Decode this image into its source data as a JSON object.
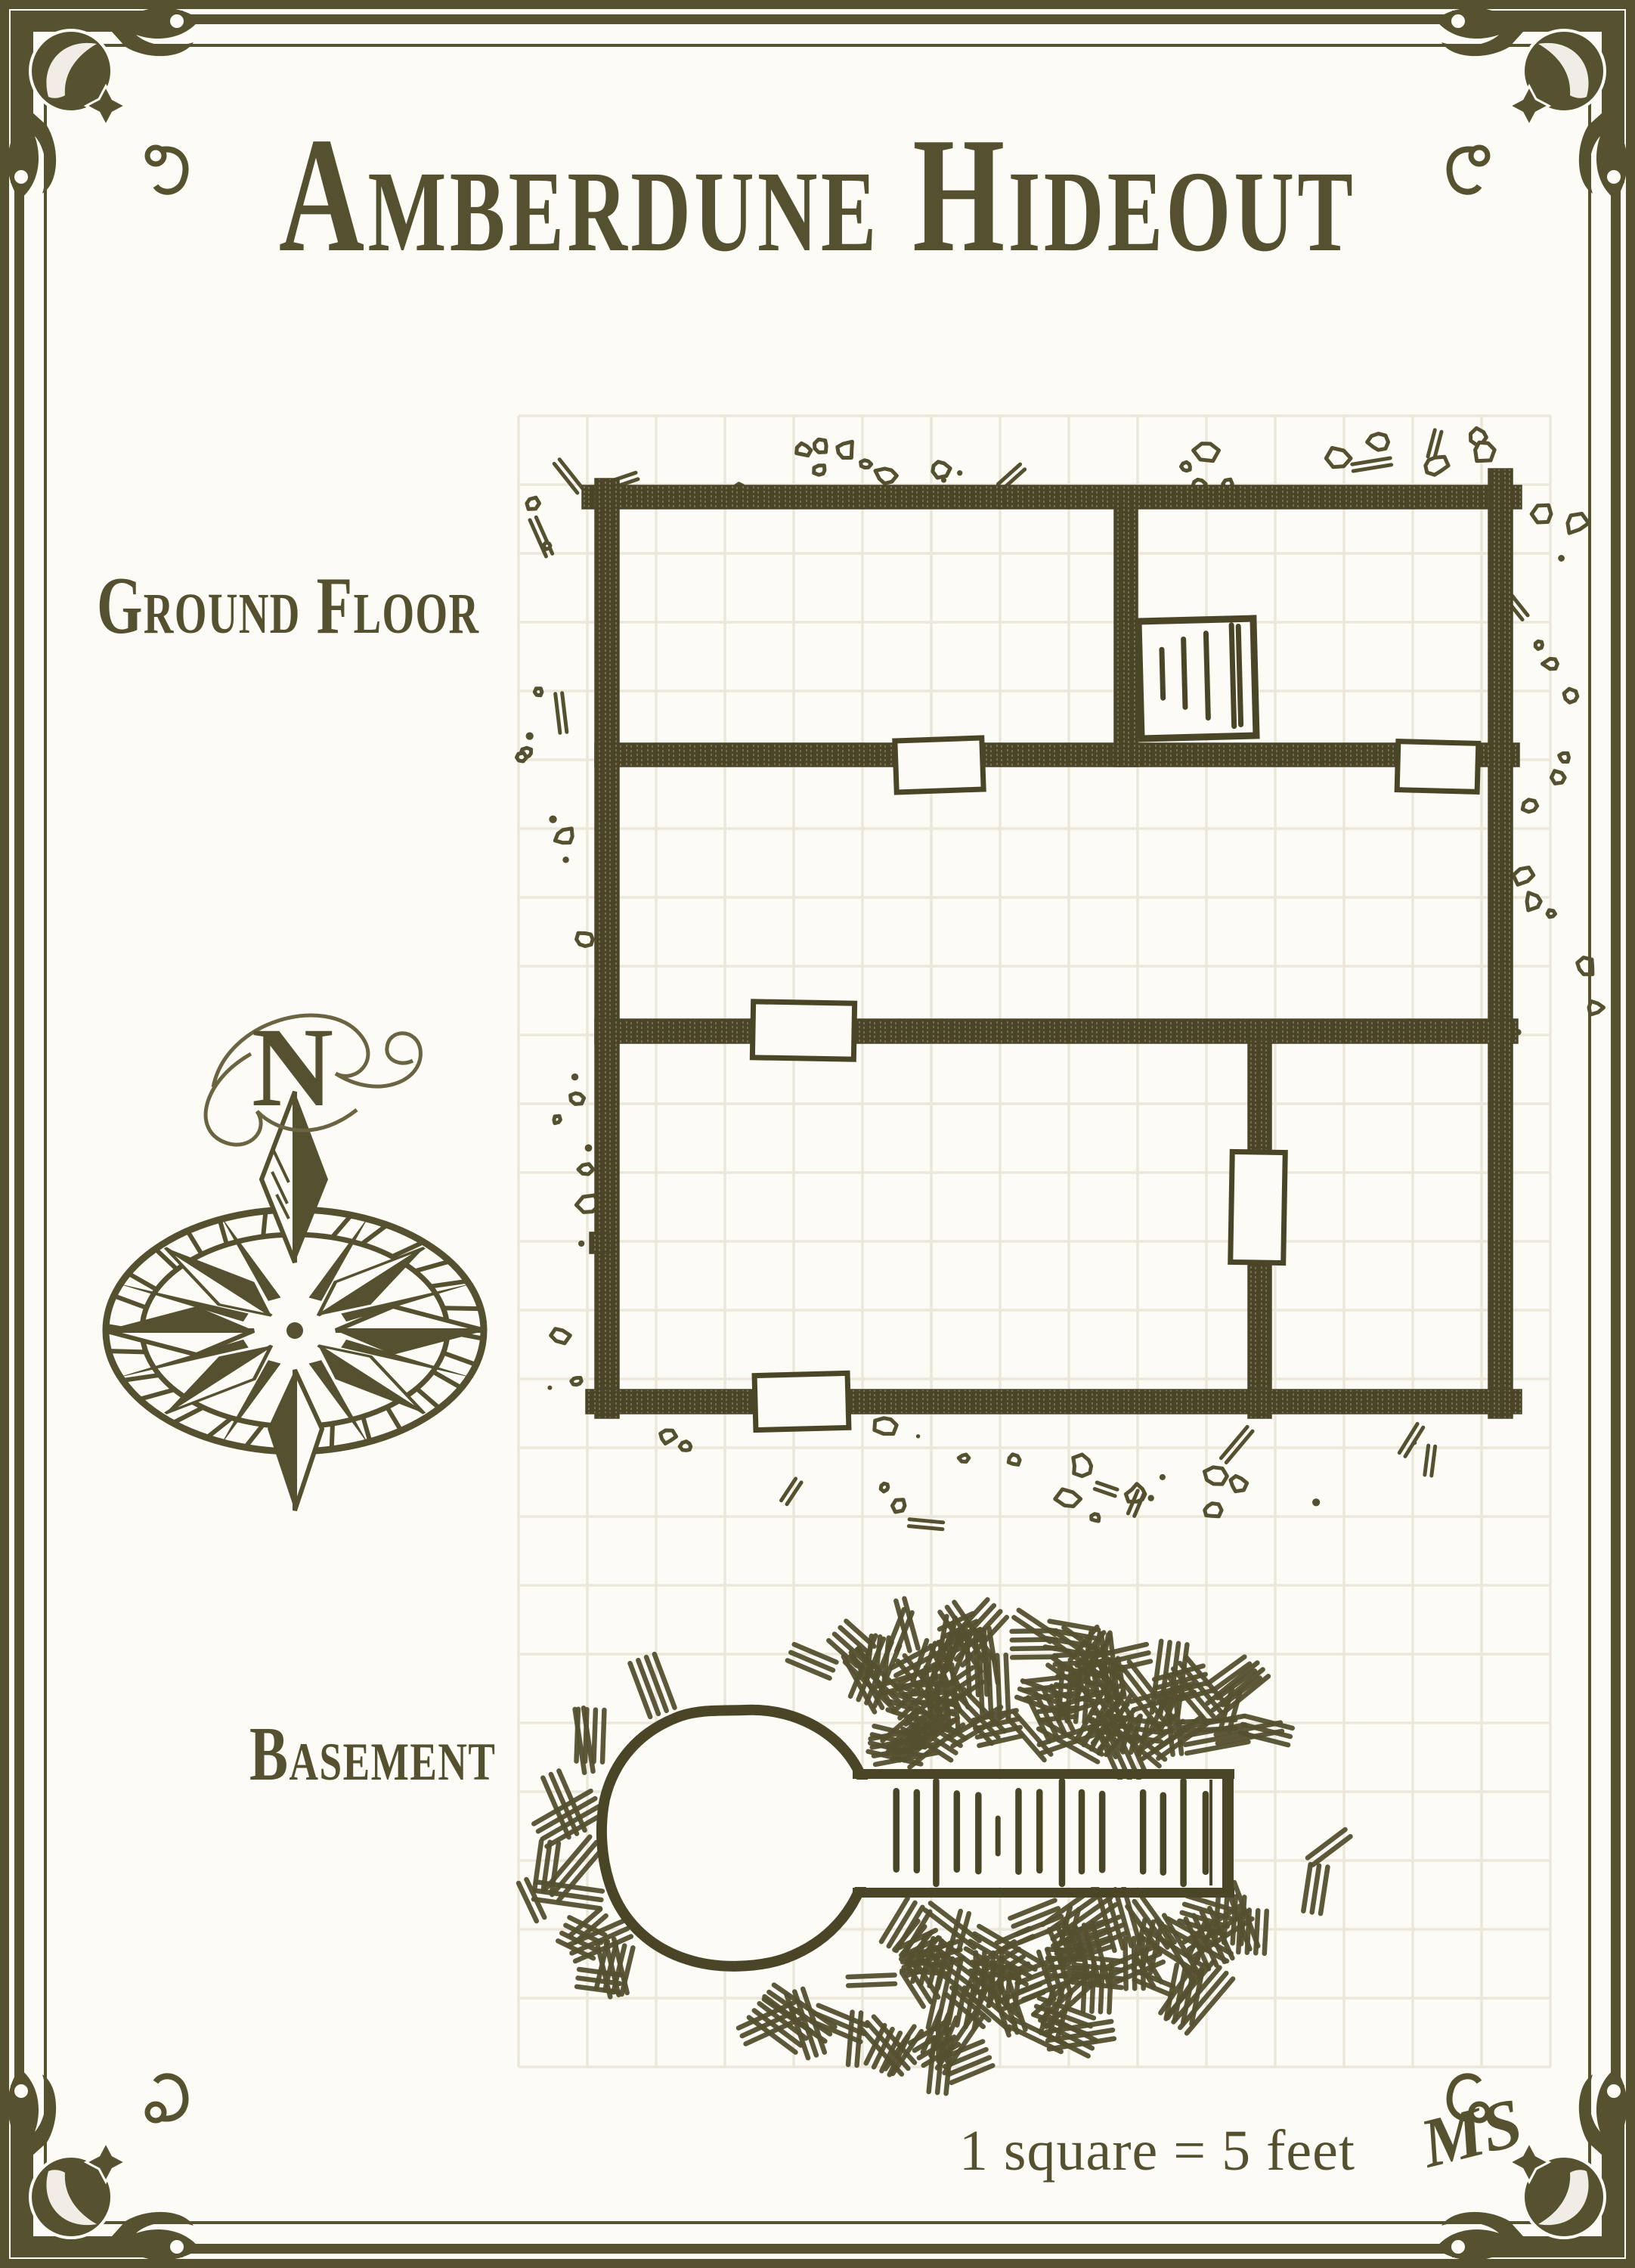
{
  "page": {
    "title": "Amberdune Hideout",
    "scale_note": "1 square = 5 feet",
    "signature": "MS"
  },
  "floors": {
    "ground": {
      "label": "Ground Floor"
    },
    "basement": {
      "label": "Basement"
    }
  },
  "compass": {
    "north_label": "N"
  },
  "map": {
    "feet_per_square": 5
  },
  "colors": {
    "ink": "#55502f",
    "wall": "#4b4528",
    "paper": "#fcfbf5",
    "grid": "#ebe7da",
    "swash": "#6b6442",
    "frame": "#56512f"
  }
}
